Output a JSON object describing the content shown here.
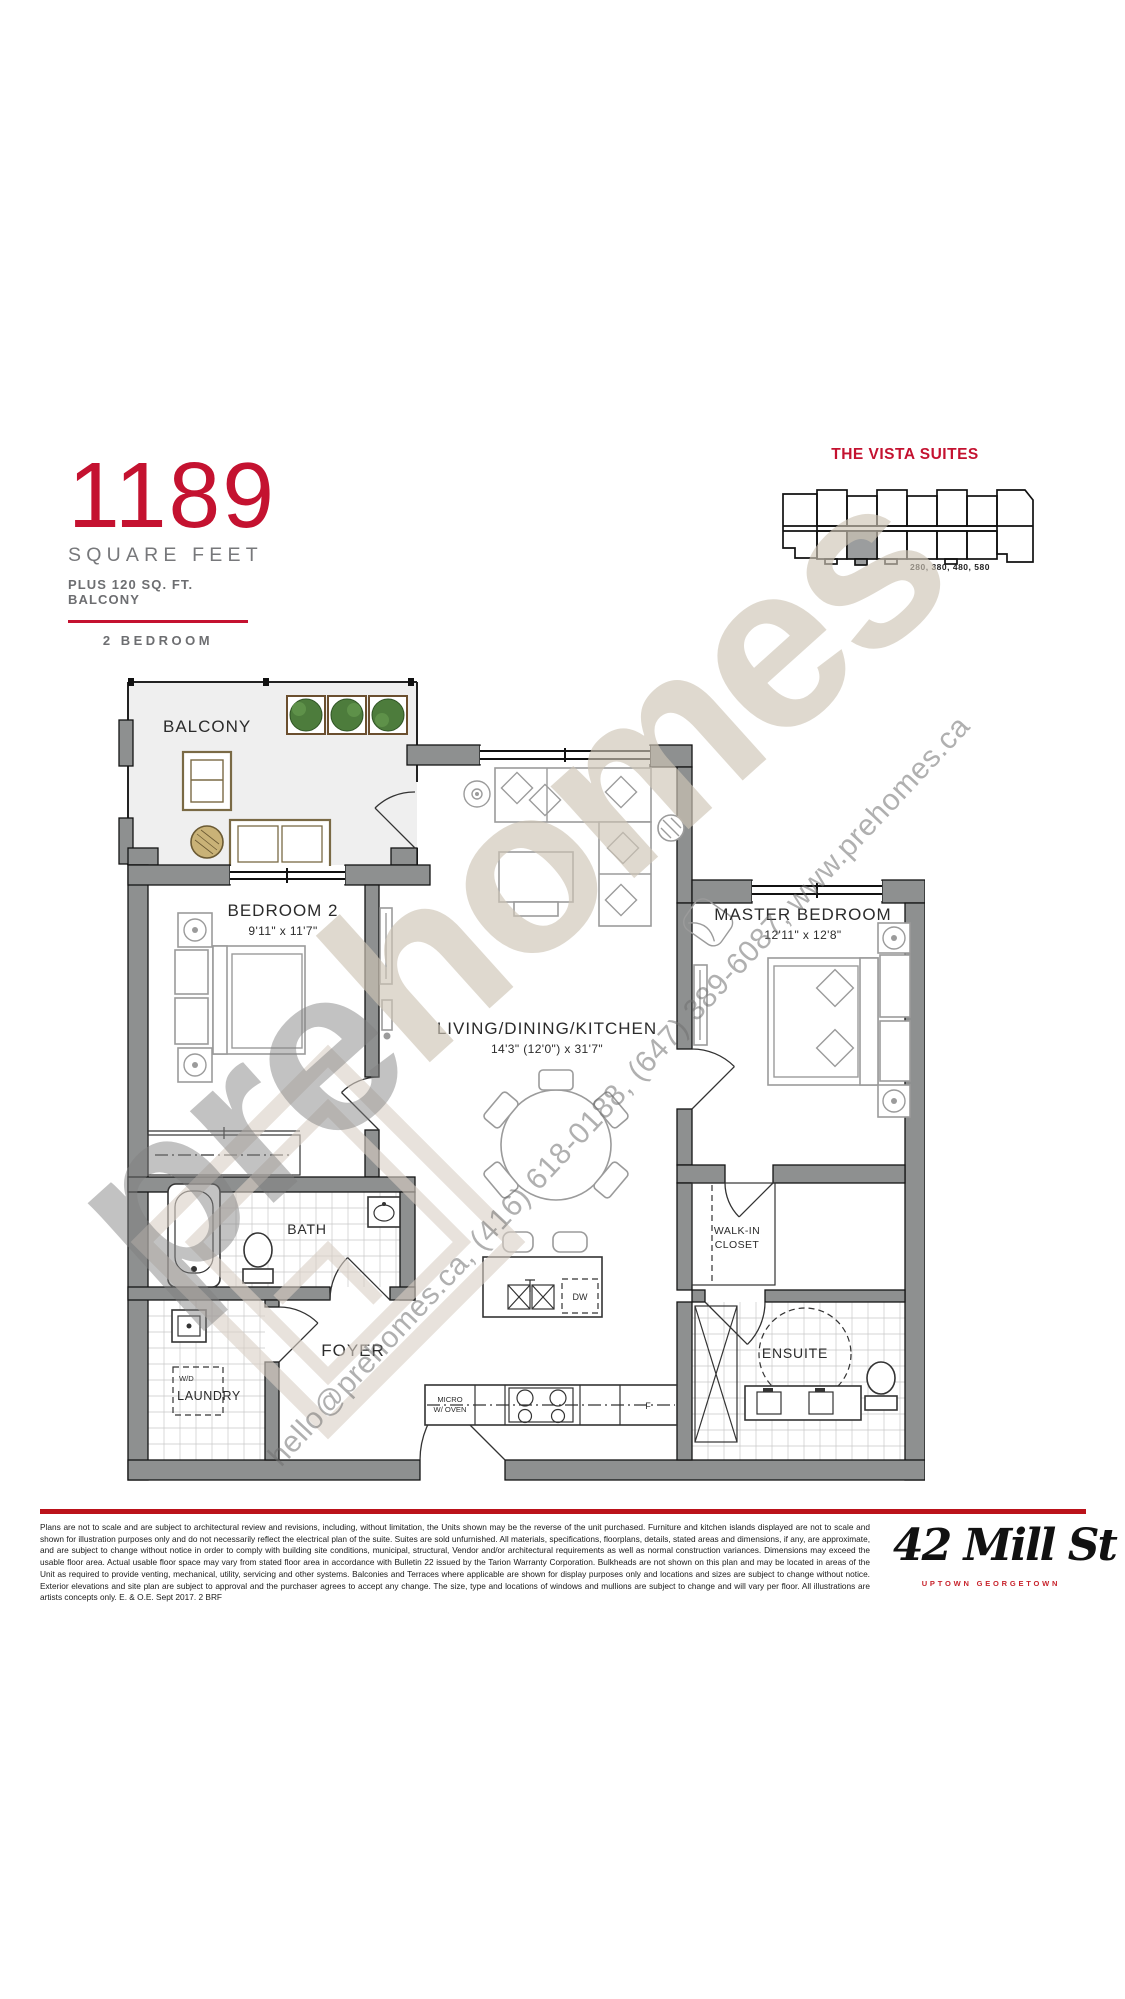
{
  "header": {
    "area_number": "1189",
    "area_label": "SQUARE FEET",
    "area_sub": "PLUS 120 SQ. FT. BALCONY",
    "unit_type": "2 BEDROOM"
  },
  "keyplan": {
    "title": "THE VISTA SUITES",
    "units": "280, 380, 480, 580"
  },
  "plan": {
    "balcony": "BALCONY",
    "bedroom2": {
      "name": "BEDROOM 2",
      "dim": "9'11\" x 11'7\""
    },
    "master": {
      "name": "MASTER BEDROOM",
      "dim": "12'11\" x 12'8\""
    },
    "living": {
      "name": "LIVING/DINING/KITCHEN",
      "dim": "14'3\" (12'0\") x 31'7\""
    },
    "bath": "BATH",
    "foyer": "FOYER",
    "laundry": "LAUNDRY",
    "washer_dryer": "W/D",
    "walkin_line1": "WALK-IN",
    "walkin_line2": "CLOSET",
    "ensuite": "ENSUITE",
    "dishwasher": "DW",
    "micro_line1": "MICRO",
    "micro_line2": "W/ OVEN",
    "fridge": "F"
  },
  "watermark": {
    "brand_pre": "pre",
    "brand_homes": "homes",
    "contact": "hello@prehomes.ca, (416) 618-0188, (647) 389-6087, www.prehomes.ca"
  },
  "footer": {
    "disclaimer": "Plans are not to scale and are subject to architectural review and revisions, including, without limitation, the Units shown may be the reverse of the unit purchased. Furniture and kitchen islands displayed are not to scale and shown for illustration purposes only and do not necessarily reflect the electrical plan of the suite. Suites are sold unfurnished. All materials, specifications, floorplans, details, stated areas and dimensions, if any, are approximate, and are subject to change without notice in order to comply with building site conditions, municipal, structural, Vendor and/or architectural requirements as well as normal construction variances. Dimensions may exceed the usable floor area. Actual usable floor space may vary from stated floor area in accordance with Bulletin 22 issued by the Tarion Warranty Corporation. Bulkheads are not shown on this plan and may be located in areas of the Unit as required to provide venting, mechanical, utility, servicing and other systems. Balconies and Terraces where applicable are shown for display purposes only and locations and sizes are subject to change without notice. Exterior elevations and site plan are subject to approval and the purchaser agrees to accept any change. The size, type and locations of windows and mullions are subject to change and will vary per floor. All illustrations are artists concepts only. E. & O.E. Sept 2017. 2 BRF",
    "brand": "42 Mill St",
    "tagline": "UPTOWN GEORGETOWN"
  },
  "colors": {
    "accent_red": "#C41230",
    "text_gray": "#77787B",
    "wall_gray": "#8E9090",
    "watermark_beige": "#D8CFC4",
    "logo_red": "#C8232C",
    "highlight_unit_gray": "#9B9D9E"
  }
}
